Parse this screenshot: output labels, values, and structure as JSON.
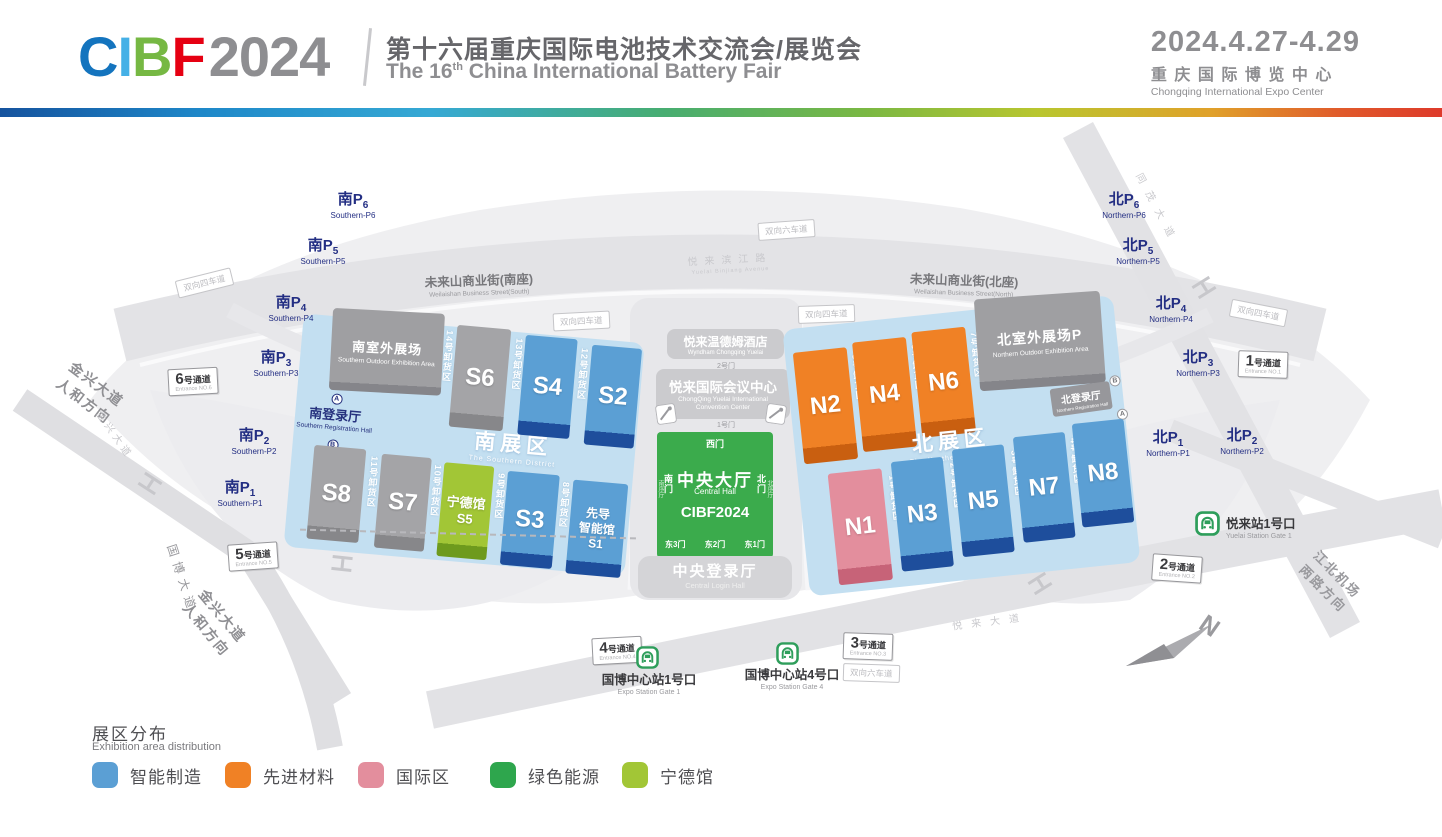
{
  "header": {
    "logo_c": "C",
    "logo_i": "I",
    "logo_b": "B",
    "logo_f": "F",
    "logo_year": "2024",
    "title_zh": "第十六届重庆国际电池技术交流会/展览会",
    "title_en_a": "The 16",
    "title_en_sup": "th",
    "title_en_b": " China International Battery Fair",
    "dates": "2024.4.27-4.29",
    "venue_zh": "重庆国际博览中心",
    "venue_en": "Chongqing International Expo Center"
  },
  "legend": {
    "title_zh": "展区分布",
    "title_en": "Exhibition area distribution",
    "items": [
      {
        "label": "智能制造",
        "color": "#5B9FD4"
      },
      {
        "label": "先进材料",
        "color": "#F08125"
      },
      {
        "label": "国际区",
        "color": "#E38E9D"
      },
      {
        "label": "绿色能源",
        "color": "#2EA64D"
      },
      {
        "label": "宁德馆",
        "color": "#A2C636"
      }
    ]
  },
  "map": {
    "south_parking": [
      {
        "zh": "南P",
        "sub": "6",
        "en": "Southern-P6"
      },
      {
        "zh": "南P",
        "sub": "5",
        "en": "Southern-P5"
      },
      {
        "zh": "南P",
        "sub": "4",
        "en": "Southern-P4"
      },
      {
        "zh": "南P",
        "sub": "3",
        "en": "Southern-P3"
      },
      {
        "zh": "南P",
        "sub": "2",
        "en": "Southern-P2"
      },
      {
        "zh": "南P",
        "sub": "1",
        "en": "Southern-P1"
      }
    ],
    "north_parking": [
      {
        "zh": "北P",
        "sub": "6",
        "en": "Northern-P6"
      },
      {
        "zh": "北P",
        "sub": "5",
        "en": "Northern-P5"
      },
      {
        "zh": "北P",
        "sub": "4",
        "en": "Northern-P4"
      },
      {
        "zh": "北P",
        "sub": "3",
        "en": "Northern-P3"
      },
      {
        "zh": "北P",
        "sub": "2",
        "en": "Northern-P2"
      },
      {
        "zh": "北P",
        "sub": "1",
        "en": "Northern-P1"
      }
    ],
    "south": {
      "zone_zh": "南展区",
      "zone_en": "The Southern District",
      "outdoor_zh": "南室外展场",
      "outdoor_en": "Southern Outdoor Exhibition Area",
      "reg_zh": "南登录厅",
      "reg_en": "Southern Registration Hall",
      "halls": [
        {
          "id": "S6"
        },
        {
          "id": "S4"
        },
        {
          "id": "S2"
        },
        {
          "id": "S8"
        },
        {
          "id": "S7"
        },
        {
          "name": "宁德馆",
          "id": "S5"
        },
        {
          "id": "S3"
        },
        {
          "name1": "先导",
          "name2": "智能馆",
          "id": "S1"
        }
      ],
      "lanes": [
        "14号卸货区",
        "13号卸货区",
        "12号卸货区",
        "11号卸货区",
        "10号卸货区",
        "9号卸货区",
        "8号卸货区"
      ]
    },
    "north": {
      "zone_zh": "北展区",
      "zone_en": "The Northern District",
      "outdoor_zh": "北室外展场P",
      "outdoor_en": "Northern Outdoor Exhibition Area",
      "reg_zh": "北登录厅",
      "reg_en": "Northern Registration Hall",
      "halls": [
        {
          "id": "N2"
        },
        {
          "id": "N4"
        },
        {
          "id": "N6"
        },
        {
          "id": "N1"
        },
        {
          "id": "N3"
        },
        {
          "id": "N5"
        },
        {
          "id": "N7"
        },
        {
          "id": "N8"
        }
      ],
      "lanes": [
        "5号卸货区",
        "6号卸货区",
        "7号卸货区",
        "1号卸货区",
        "2号卸货区",
        "3号卸货区",
        "4号卸货区"
      ]
    },
    "central": {
      "hotel_zh": "悦来温德姆酒店",
      "hotel_en": "Wyndham Chongqing Yuelai",
      "convention_zh": "悦来国际会议中心",
      "convention_en": "ChongQing Yuelai International Convention Center",
      "gate_door2": "2号门",
      "gate_door1": "1号门",
      "hall_zh": "中央大厅",
      "hall_en": "Central Hall",
      "brand": "CIBF2024",
      "gate_west": "西门",
      "gate_south": "南门",
      "gate_north": "北门",
      "gate_e3": "东3门",
      "gate_e2": "东2门",
      "gate_e1": "东1门",
      "foyer_south": "南序厅",
      "foyer_north": "北序厅",
      "login_zh": "中央登录厅",
      "login_en": "Central Login Hall"
    },
    "roads": {
      "wlsn_south_zh": "未来山商业街(南座)",
      "wlsn_south_en": "Weilaishan Business Street(South)",
      "wlsn_north_zh": "未来山商业街(北座)",
      "wlsn_north_en": "Weilaishan Business Street(North)",
      "yuelai_binjiang_zh": "悦来滨江路",
      "yuelai_binjiang_en": "Yuelai Binjiang Avenue",
      "lane4": "双向四车道",
      "lane6": "双向六车道",
      "jinxing_zh": "金兴大道",
      "renhe_zh": "人和方向",
      "guobo_zh": "国博大道",
      "jiangbei_zh": "江北机场",
      "lianglu_zh": "两路方向",
      "tongmao_zh": "同茂大道",
      "yuelai_ave_zh": "悦来大道"
    },
    "passages": [
      {
        "num": "6",
        "suf": "号通道",
        "en": "Entrance NO.6"
      },
      {
        "num": "5",
        "suf": "号通道",
        "en": "Entrance NO.5"
      },
      {
        "num": "4",
        "suf": "号通道",
        "en": "Entrance NO.4"
      },
      {
        "num": "3",
        "suf": "号通道",
        "en": "Entrance NO.3"
      },
      {
        "num": "2",
        "suf": "号通道",
        "en": "Entrance NO.2"
      },
      {
        "num": "1",
        "suf": "号通道",
        "en": "Entrance NO.1"
      }
    ],
    "stations": {
      "expo1_zh": "国博中心站1号口",
      "expo1_en": "Expo Station Gate 1",
      "expo4_zh": "国博中心站4号口",
      "expo4_en": "Expo Station Gate 4",
      "yuelai_zh": "悦来站1号口",
      "yuelai_en": "Yuelai Station Gate 1"
    },
    "compass_n": "N",
    "marker_a": "A",
    "marker_b": "B"
  }
}
